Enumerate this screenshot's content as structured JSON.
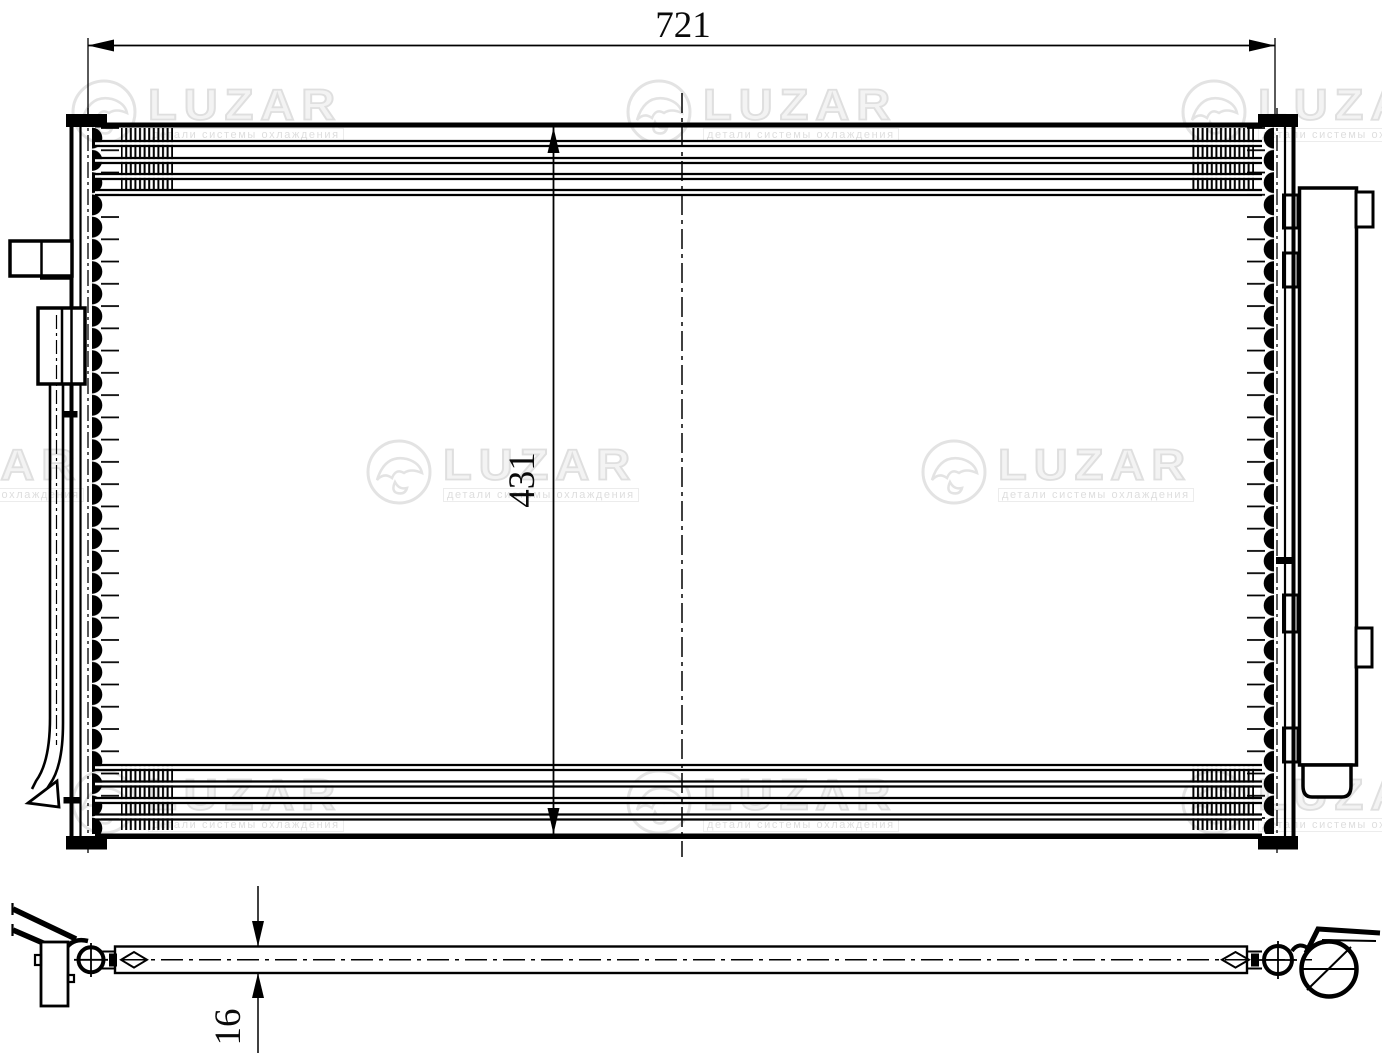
{
  "drawing": {
    "kind": "condenser-technical-drawing",
    "dimensions": {
      "width": "721",
      "height": "431",
      "thickness": "16"
    }
  },
  "watermark": {
    "brand": "LUZAR",
    "tagline": "детали системы охлаждения"
  },
  "colors": {
    "line": "#000000",
    "background": "#ffffff",
    "watermark": "#e3e3e3"
  }
}
